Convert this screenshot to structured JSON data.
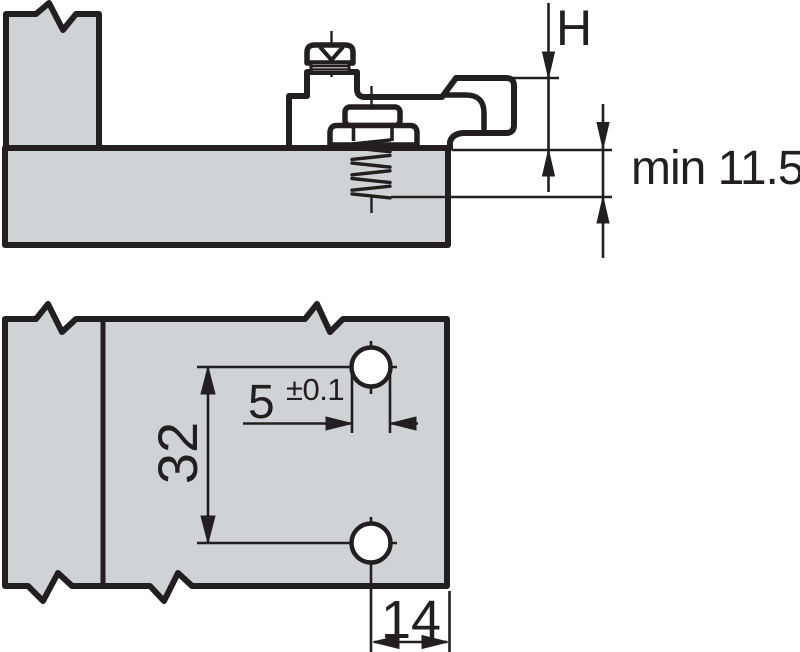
{
  "drawing": {
    "kind": "technical-dimension-drawing",
    "subject": "hinge mounting plate on cabinet panel",
    "colors": {
      "line": "#231f20",
      "board_fill": "#d0d3d5",
      "part_fill": "#ffffff",
      "background": "#ffffff"
    },
    "side_view": {
      "description": "side section view of mounting plate screwed onto panel",
      "labels": {
        "plate_height": "H",
        "min_screw_depth": "min 11.5"
      }
    },
    "plan_view": {
      "description": "drilling pattern plan view with two system holes",
      "labels": {
        "hole_spacing": "32",
        "hole_diameter": "5",
        "hole_diameter_tolerance": "±0.1",
        "edge_distance": "14"
      }
    }
  }
}
